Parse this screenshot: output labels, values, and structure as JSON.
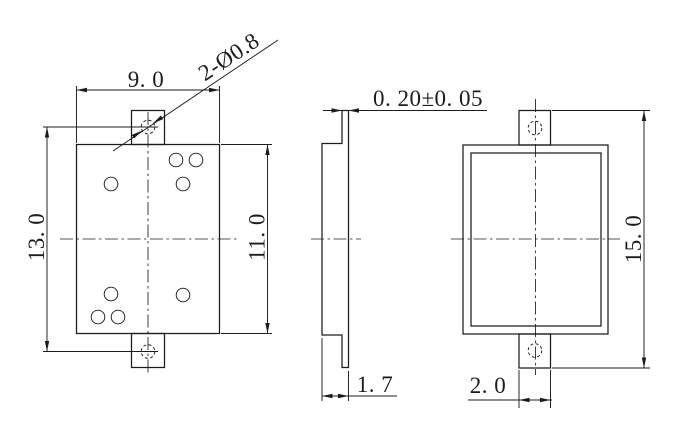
{
  "colors": {
    "background": "#ffffff",
    "line": "#1c1c1f"
  },
  "drawing": {
    "description": "three-view mechanical part drawing with mounting tabs",
    "front": {
      "width": "9. 0",
      "overall_height": "13. 0",
      "body_height": "11. 0",
      "hole_callout": "2-Ø0.8"
    },
    "side": {
      "lid_thickness": "0. 20±0. 05",
      "body_thickness": "1. 7"
    },
    "back": {
      "overall_height": "15. 0",
      "tab_width": "2. 0"
    }
  }
}
